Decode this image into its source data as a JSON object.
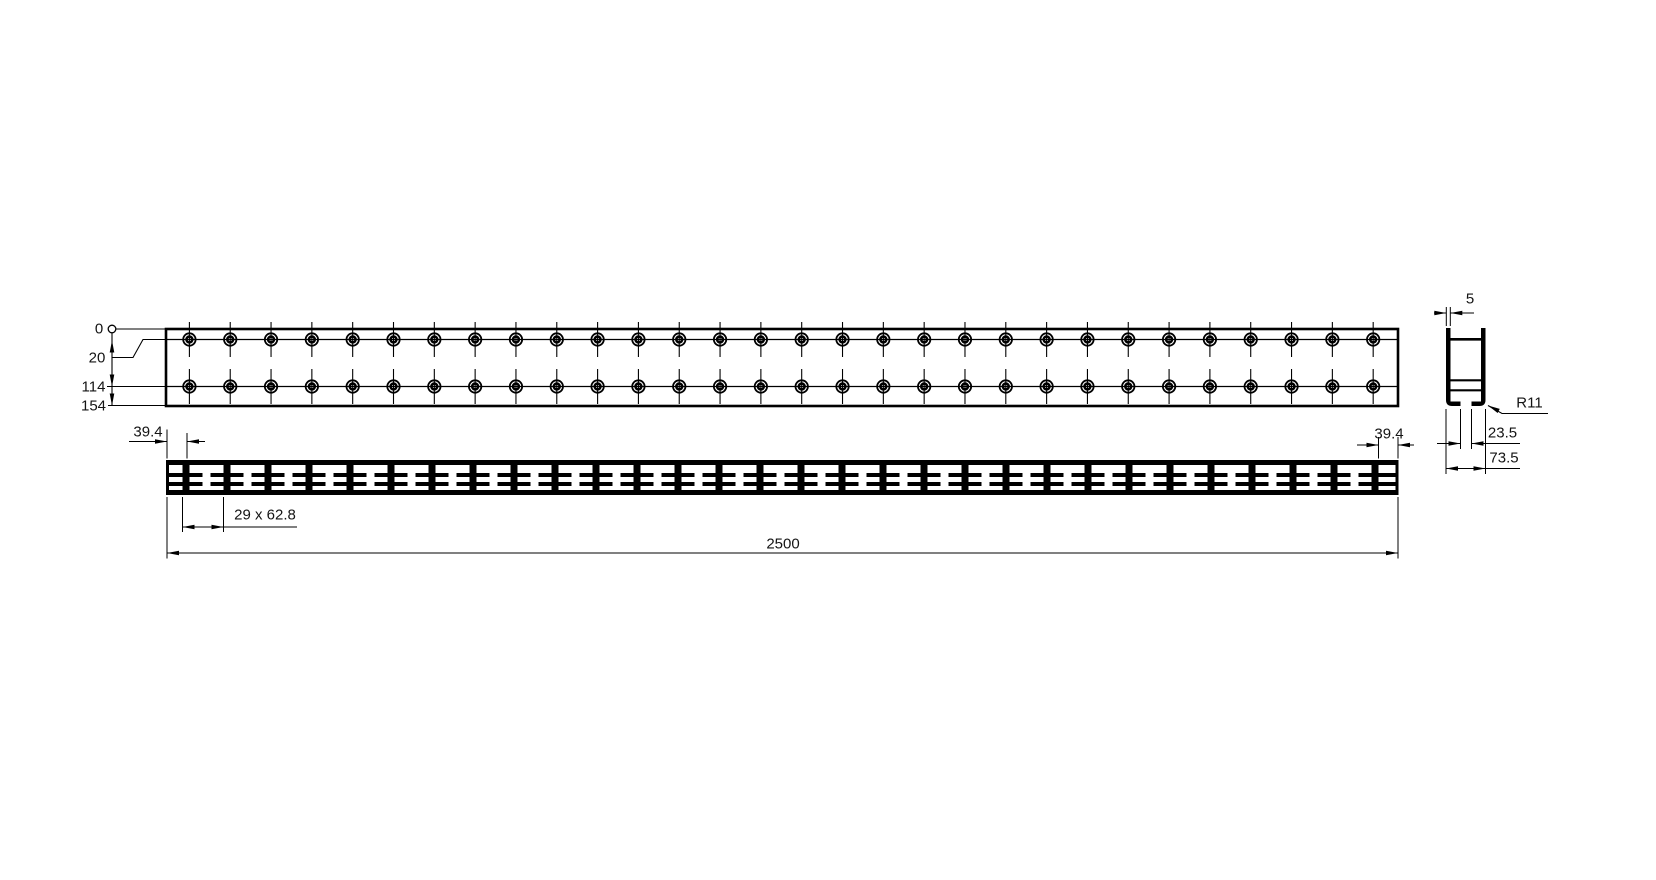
{
  "drawing": {
    "title": "Slotted mounting rail - dimensioned 3-view drawing",
    "views": {
      "hole_rows": 2,
      "holes_per_row": 30,
      "web_count": 30,
      "slot_count": 29
    },
    "ordinate": {
      "labels": [
        "0",
        "20",
        "114",
        "154"
      ]
    },
    "dims": {
      "left_end_offset": "39.4",
      "slot_pitch": "29 x 62.8",
      "overall_length": "2500",
      "right_end_offset": "39.4",
      "lip_thickness": "5",
      "corner_radius": "R11",
      "slot_opening": "23.5",
      "profile_width": "73.5"
    },
    "colors": {
      "line": "#000000",
      "background": "#ffffff",
      "text": "#141414"
    }
  }
}
